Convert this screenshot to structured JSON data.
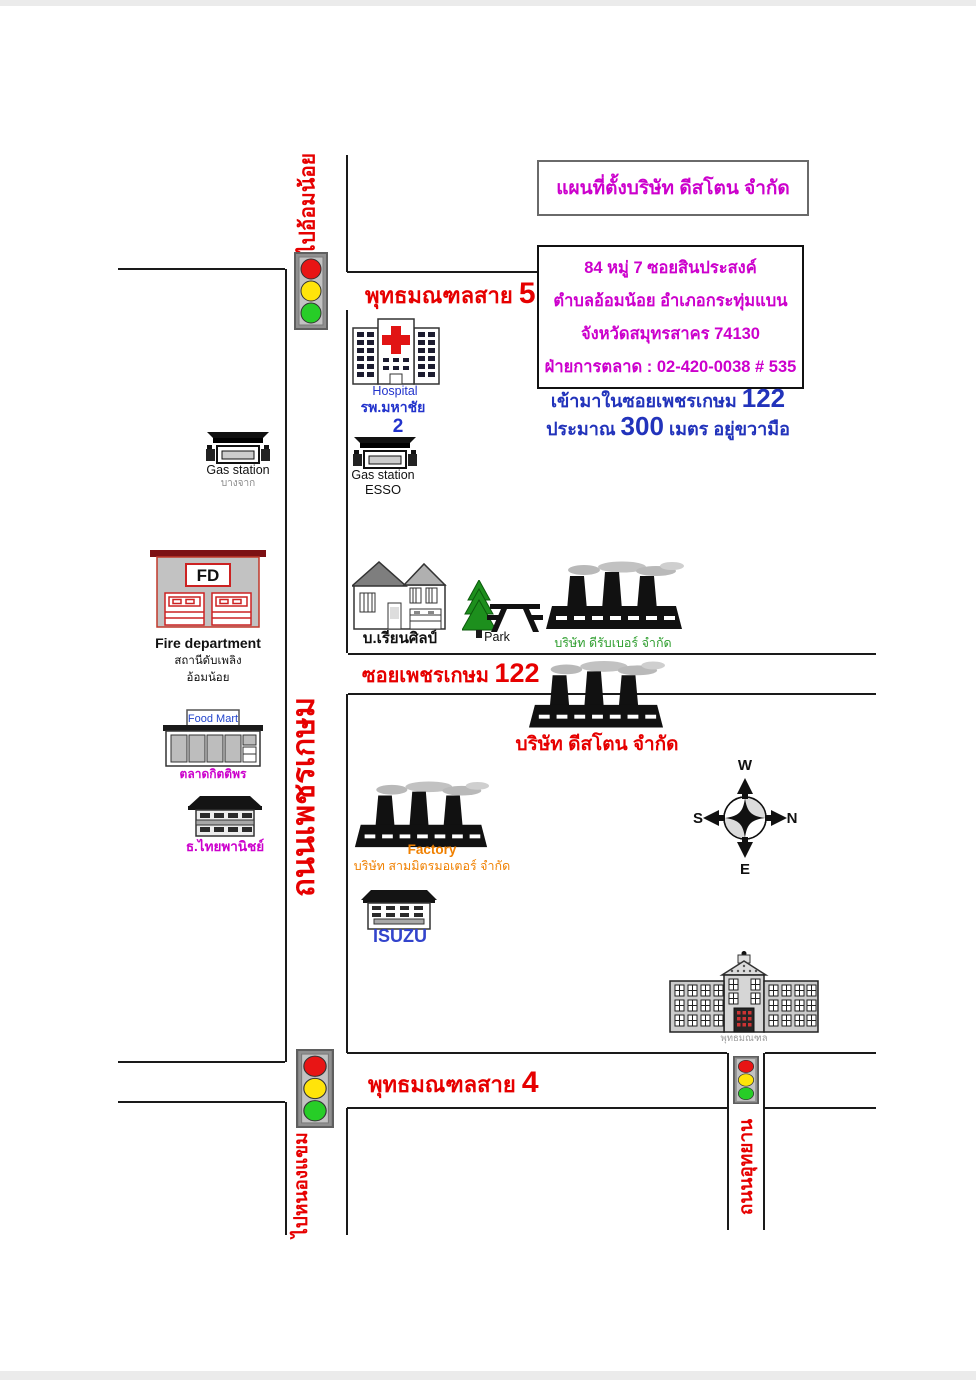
{
  "header": {
    "title": "แผนที่ตั้งบริษัท ดีสโตน จำกัด",
    "address_line1": "84 หมู่ 7 ซอยสินประสงค์",
    "address_line2": "ตำบลอ้อมน้อย อำเภอกระทุ่มแบน",
    "address_line3": "จังหวัดสมุทรสาคร 74130",
    "address_line4": "ฝ่ายการตลาด : 02-420-0038 # 535",
    "note_line1_text": "เข้ามาในซอยเพชรเกษม",
    "note_line1_number": "122",
    "note_line2_word1": "ประมาณ",
    "note_line2_number": "300",
    "note_line2_rest": "เมตร อยู่ขวามือ"
  },
  "roads": {
    "sai5_name": "พุทธมณฑลสาย",
    "sai5_number": "5",
    "soi122_name": "ซอยเพชรเกษม",
    "soi122_number": "122",
    "sai4_name": "พุทธมณฑลสาย",
    "sai4_number": "4",
    "phetkasem": "ถนนเพชรเกษม",
    "utthayan": "ถนนอุทยาน",
    "to_omnoi": "ไปอ้อมน้อย",
    "to_nongkhaem": "ไปหนองแขม"
  },
  "places": {
    "hospital_en": "Hospital",
    "hospital_th": "รพ.มหาชัย",
    "hospital_no": "2",
    "gas1_label": "Gas station",
    "gas1_brand": "บางจาก",
    "gas2_label": "Gas station",
    "gas2_brand": "ESSO",
    "fire_sign": "FD",
    "fire_en": "Fire department",
    "fire_th1": "สถานีดับเพลิง",
    "fire_th2": "อ้อมน้อย",
    "foodmart_sign": "Food Mart",
    "foodmart_th": "ตลาดกิตติพร",
    "bank_th": "ธ.ไทยพานิชย์",
    "school_th": "บ.เรียนศิลป์",
    "park_en": "Park",
    "drubber_th": "บริษัท ดีรับเบอร์ จำกัด",
    "deestone_th": "บริษัท ดีสโตน จำกัด",
    "factory_en": "Factory",
    "sammitr_th": "บริษัท สามมิตรมอเตอร์ จำกัด",
    "isuzu": "ISUZU",
    "monthon_th": "พุทธมณฑล"
  },
  "compass": {
    "top": "W",
    "right": "N",
    "bottom": "E",
    "left": "S"
  },
  "colors": {
    "road_line": "#1a1a1a",
    "red_label": "#e60000",
    "magenta": "#cc00cc",
    "blue": "#2233bb",
    "green": "#2e9e2e",
    "orange": "#f08000",
    "traffic_red": "#e81515",
    "traffic_yellow": "#ffe40a",
    "traffic_green": "#27cd27"
  },
  "icons": {
    "traffic-light-icon": "three stacked red/yellow/green circles in gray box",
    "hospital-icon": "building with red cross",
    "gas-station-icon": "black canopy with pumps",
    "fire-station-icon": "gray building with FD sign and red doors",
    "food-mart-icon": "storefront with sign",
    "bank-icon": "building with black awning",
    "house-icon": "two-story house",
    "tree-icon": "green pine tree",
    "picnic-table-icon": "black picnic table silhouette",
    "factory-icon": "black factory silhouette with smoking chimneys",
    "office-building-icon": "small building with window rows",
    "government-building-icon": "wide classical building with pediment and cupola",
    "compass-rose-icon": "circle with four arrows W/N/E/S"
  }
}
